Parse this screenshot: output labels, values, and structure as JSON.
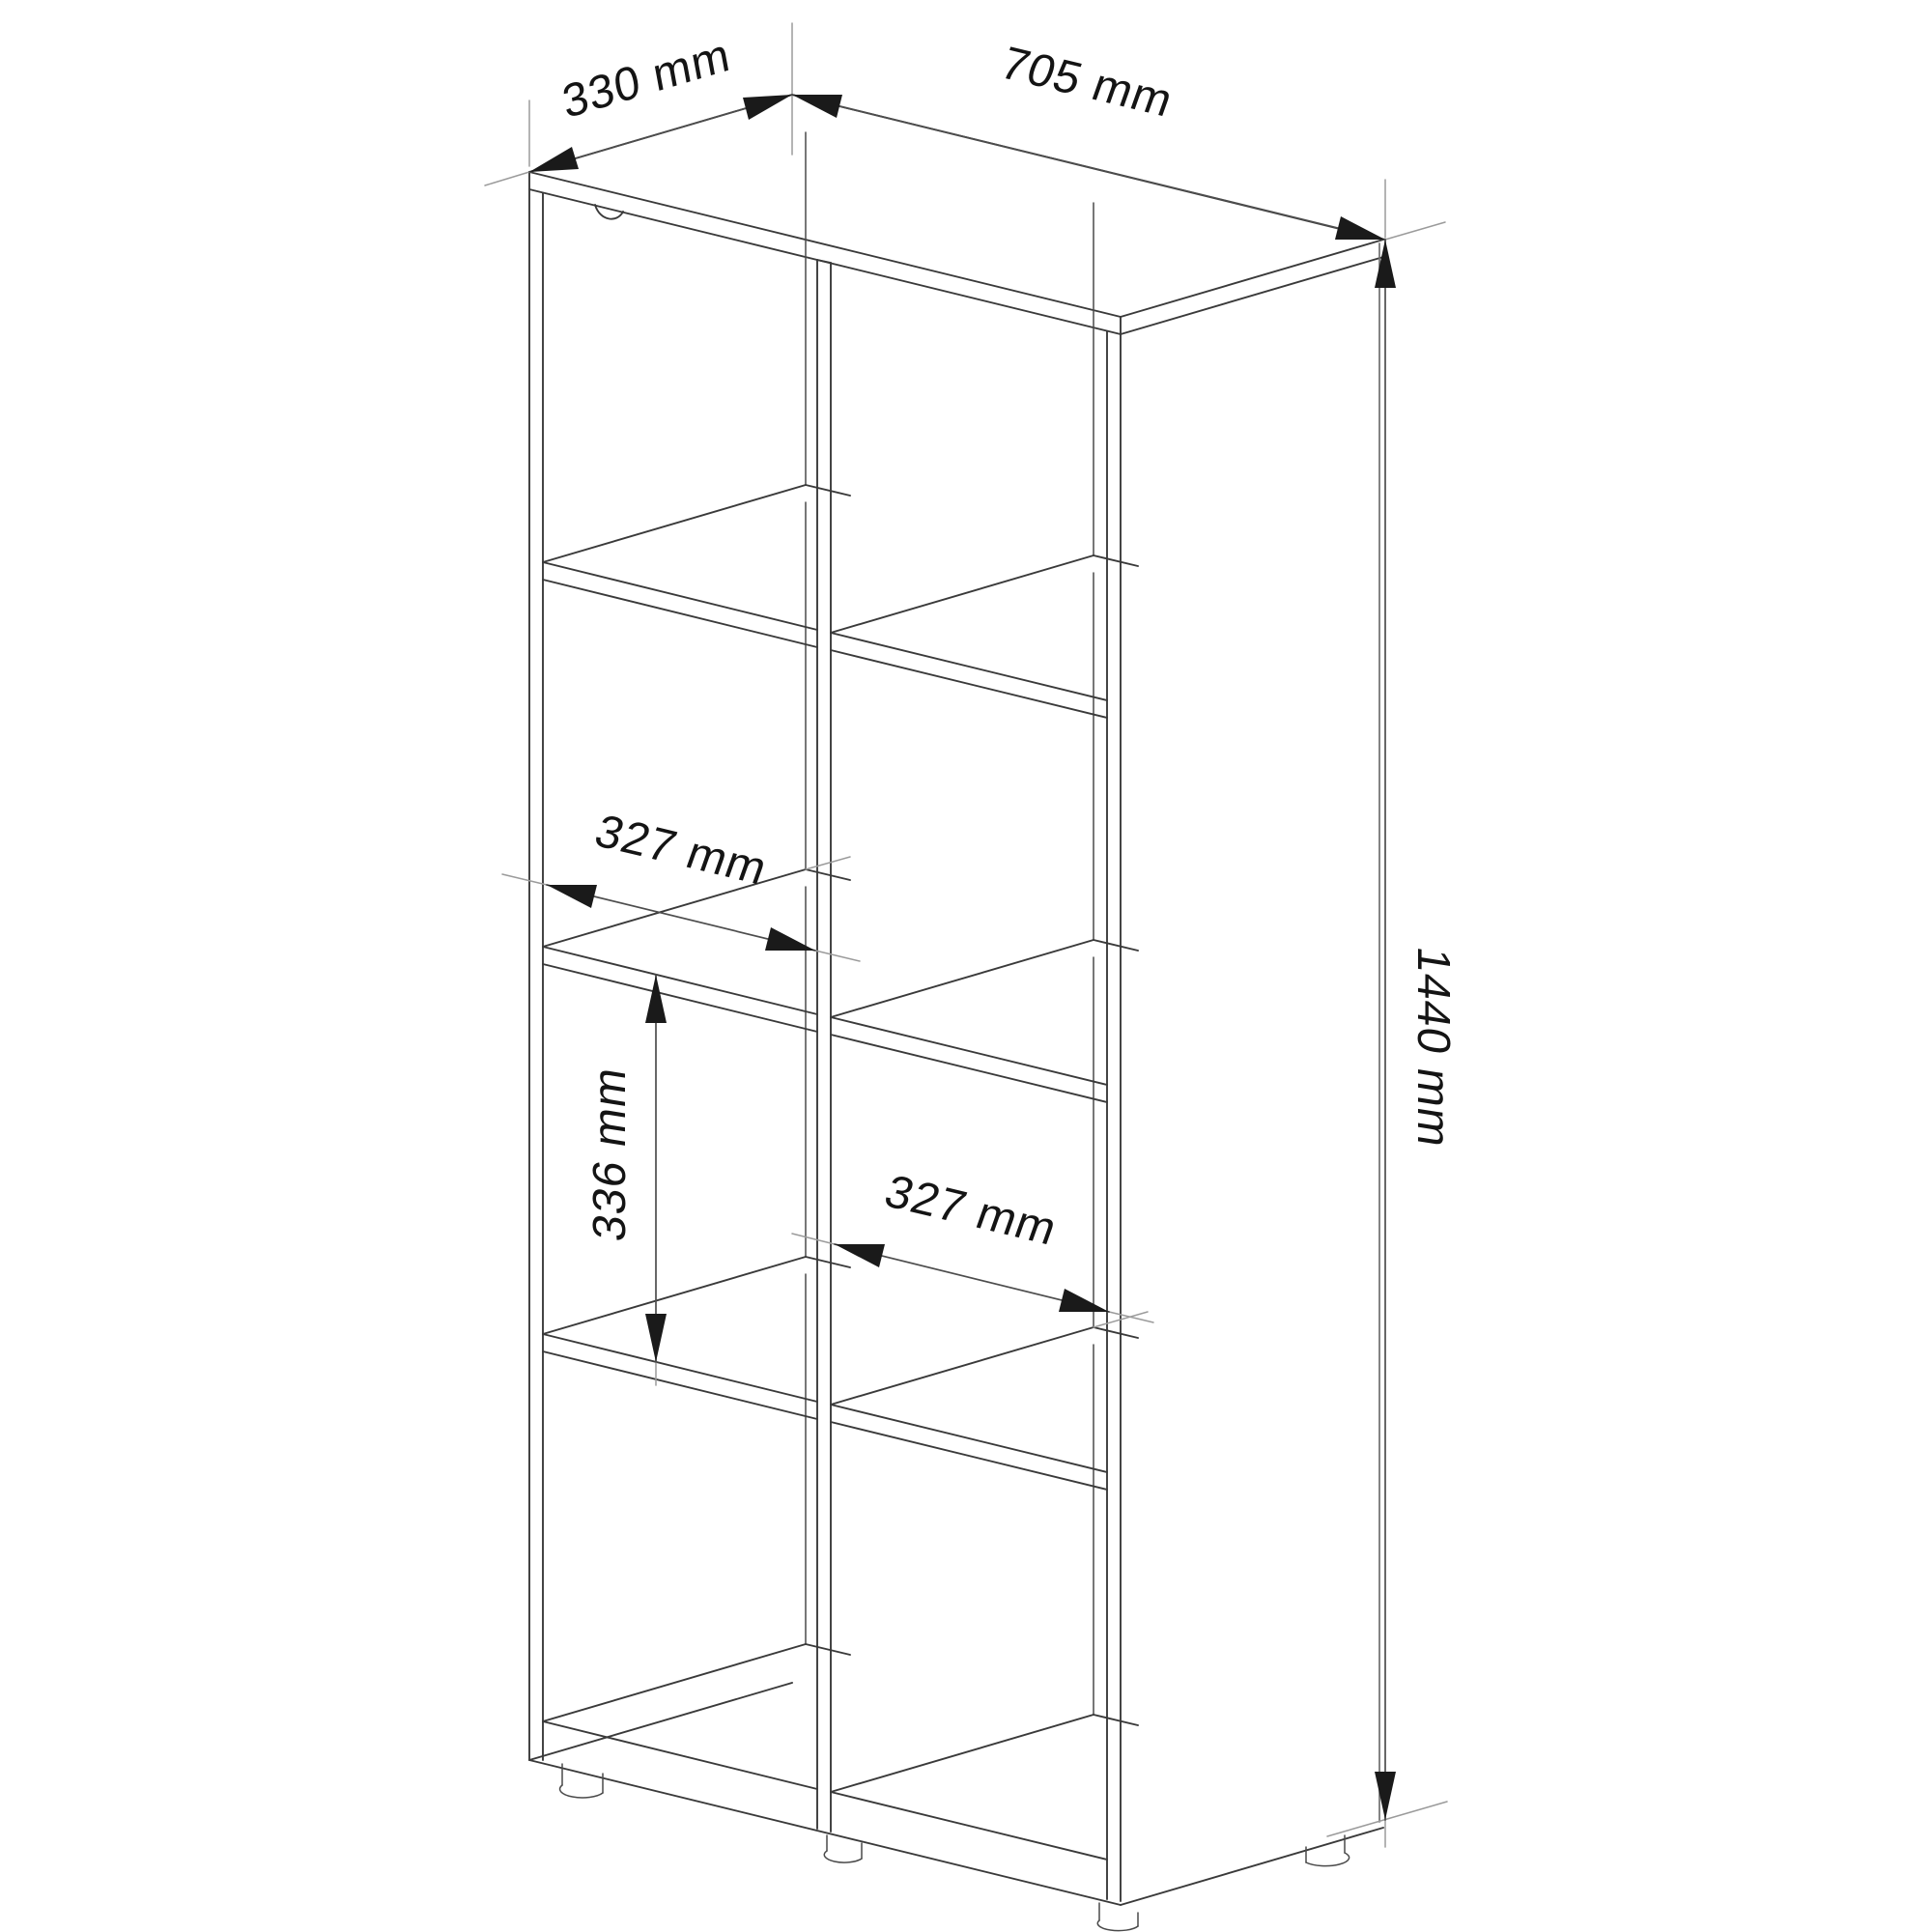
{
  "diagram": {
    "kind": "furniture-dimension-drawing",
    "background_color": "#ffffff",
    "line_color": "#3a3a3a",
    "dimensions": {
      "depth": "330 mm",
      "width": "705 mm",
      "height": "1440 mm",
      "inner_width_left": "327 mm",
      "inner_height": "336 mm",
      "inner_width_right": "327 mm"
    }
  }
}
